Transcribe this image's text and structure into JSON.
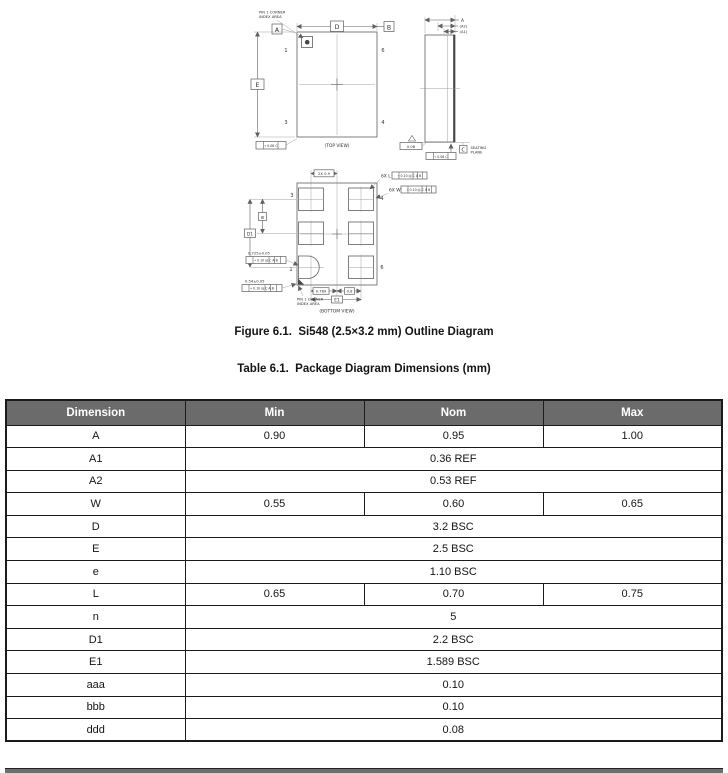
{
  "figure": {
    "caption": "Figure 6.1.  Si548 (2.5×3.2 mm) Outline Diagram",
    "top_view": {
      "view_label": "(TOP VIEW)",
      "pin1_note_line1": "PIN 1 CORNER",
      "pin1_note_line2": "INDEX AREA",
      "dim_d": "D",
      "dim_e": "E",
      "datum_a": "A",
      "datum_b": "B",
      "pin_1": "1",
      "pin_3": "3",
      "pin_6": "6",
      "pin_4": "4",
      "tolerance_callout": "⌖ 0.08 C"
    },
    "side_view": {
      "dim_a": "A",
      "dim_a2": "(A2)",
      "dim_a1": "(A1)",
      "datum_c": "C",
      "seating_line1": "SEATING",
      "seating_line2": "PLANE",
      "flatness_callout": "0.08",
      "position_callout": "⌖ 0.08 C"
    },
    "bottom_view": {
      "view_label": "(BOTTOM VIEW)",
      "pin1_note_line1": "PIN 1 CORNER",
      "pin1_note_line2": "INDEX AREA",
      "pad_length_label": "6X L",
      "pad_length_tol": "⌖ 0.10 Ⓜ C A B",
      "pad_width_label": "6X W",
      "pad_width_tol": "⌖ 0.10 Ⓜ C A B",
      "dim_top": "2X 0.9",
      "dim_e": "e",
      "dim_d1": "D1",
      "dim_e1": "E1",
      "dim_left_half": "0.789",
      "dim_right_half": "0.8",
      "dim_pin1_x": "0.725±0.05",
      "dim_pin1_x_tol": "⌖ 0.10 Ⓜ C A B",
      "dim_pin1_y": "0.54±0.05",
      "dim_pin1_y_tol": "⌖ 0.10 Ⓜ C A B",
      "pin_1": "1",
      "pin_3": "3",
      "pin_4": "4",
      "pin_6": "6"
    }
  },
  "table": {
    "title": "Table 6.1.  Package Diagram Dimensions (mm)",
    "columns": [
      "Dimension",
      "Min",
      "Nom",
      "Max"
    ],
    "rows": [
      {
        "dimension": "A",
        "min": "0.90",
        "nom": "0.95",
        "max": "1.00"
      },
      {
        "dimension": "A1",
        "span": "0.36 REF"
      },
      {
        "dimension": "A2",
        "span": "0.53 REF"
      },
      {
        "dimension": "W",
        "min": "0.55",
        "nom": "0.60",
        "max": "0.65"
      },
      {
        "dimension": "D",
        "span": "3.2 BSC"
      },
      {
        "dimension": "E",
        "span": "2.5 BSC"
      },
      {
        "dimension": "e",
        "span": "1.10 BSC"
      },
      {
        "dimension": "L",
        "min": "0.65",
        "nom": "0.70",
        "max": "0.75"
      },
      {
        "dimension": "n",
        "span": "5"
      },
      {
        "dimension": "D1",
        "span": "2.2 BSC"
      },
      {
        "dimension": "E1",
        "span": "1.589 BSC"
      },
      {
        "dimension": "aaa",
        "span": "0.10"
      },
      {
        "dimension": "bbb",
        "span": "0.10"
      },
      {
        "dimension": "ddd",
        "span": "0.08"
      }
    ]
  },
  "colors": {
    "table_header_bg": "#6b6b6b",
    "table_header_text": "#ffffff",
    "table_border": "#1b1b1b",
    "drawing_stroke": "#5f5f5f",
    "page_bg": "#ffffff"
  }
}
